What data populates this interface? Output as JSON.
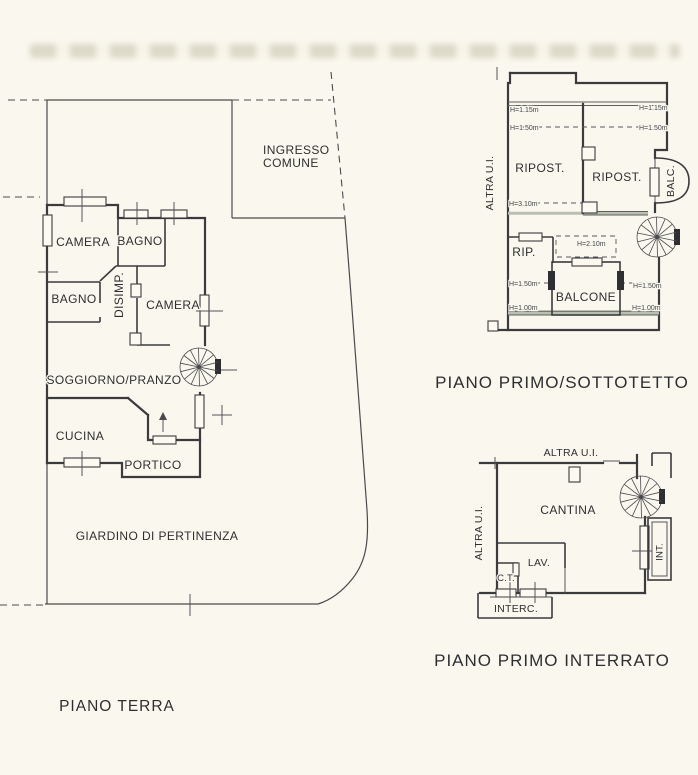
{
  "canvas": {
    "background": "#FAF8EE",
    "ink": "#3B3B3E",
    "height_line_grey": "#B9C0B2"
  },
  "ground_floor": {
    "title": "PIANO TERRA",
    "labels": {
      "camera_1": "CAMERA",
      "bagno_1": "BAGNO",
      "bagno_2": "BAGNO",
      "disimpegno": "DISIMP.",
      "camera_2": "CAMERA",
      "soggiorno_pranzo": "SOGGIORNO/PRANZO",
      "cucina": "CUCINA",
      "portico": "PORTICO",
      "giardino": "GIARDINO DI PERTINENZA",
      "ingresso_line1": "INGRESSO",
      "ingresso_line2": "COMUNE"
    }
  },
  "first_floor": {
    "title": "PIANO PRIMO/SOTTOTETTO",
    "labels": {
      "altra_ui": "ALTRA U.I.",
      "ripost_1": "RIPOST.",
      "ripost_2": "RIPOST.",
      "balc": "BALC.",
      "rip": "RIP.",
      "balcone": "BALCONE"
    },
    "heights": {
      "h115_l": "H=1.15m",
      "h115_r": "H=1.15m",
      "h150_tl": "H=1.50m",
      "h150_tr": "H=1.50m",
      "h310": "H=3.10m",
      "h210": "H=2.10m",
      "h150_ml": "H=1.50m",
      "h150_mr": "H=1.50m",
      "h100_l": "H=1.00m",
      "h100_r": "H=1.00m"
    }
  },
  "basement": {
    "title": "PIANO PRIMO INTERRATO",
    "labels": {
      "altra_ui_top": "ALTRA U.I.",
      "altra_ui_side": "ALTRA U.I.",
      "cantina": "CANTINA",
      "lav": "LAV.",
      "ct": "C.T.",
      "interc": "INTERC.",
      "int": "INT."
    }
  }
}
